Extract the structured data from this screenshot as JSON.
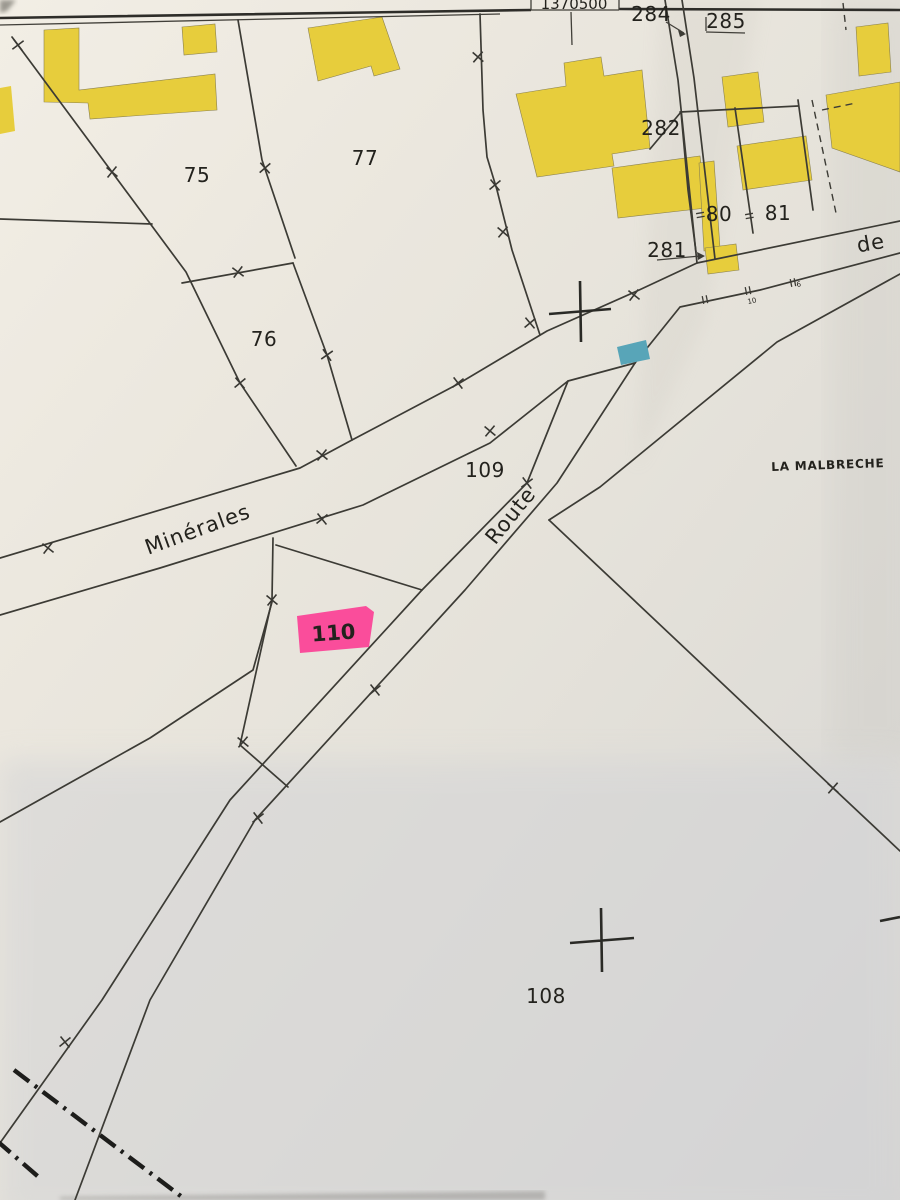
{
  "map": {
    "grid_label": "1370500",
    "locality": "LA MALBRECHE",
    "streets": {
      "minerales": "Minérales",
      "route": "Route",
      "de": "de"
    },
    "parcels": {
      "p75": "75",
      "p76": "76",
      "p77": "77",
      "p80": "80",
      "p81": "81",
      "p108": "108",
      "p109": "109",
      "p110": "110",
      "p281": "281",
      "p282": "282",
      "p284": "284",
      "p285": "285"
    },
    "house_numbers": {
      "n10": "10",
      "n6": "6"
    },
    "highlighted_parcel": "110",
    "colors": {
      "building_fill": "#e7cd3c",
      "highlight_pink": "#fa4d9b",
      "marker_teal": "#58a5b8",
      "boundary_line": "#3c3b35",
      "paper": "#e9e5de"
    }
  }
}
